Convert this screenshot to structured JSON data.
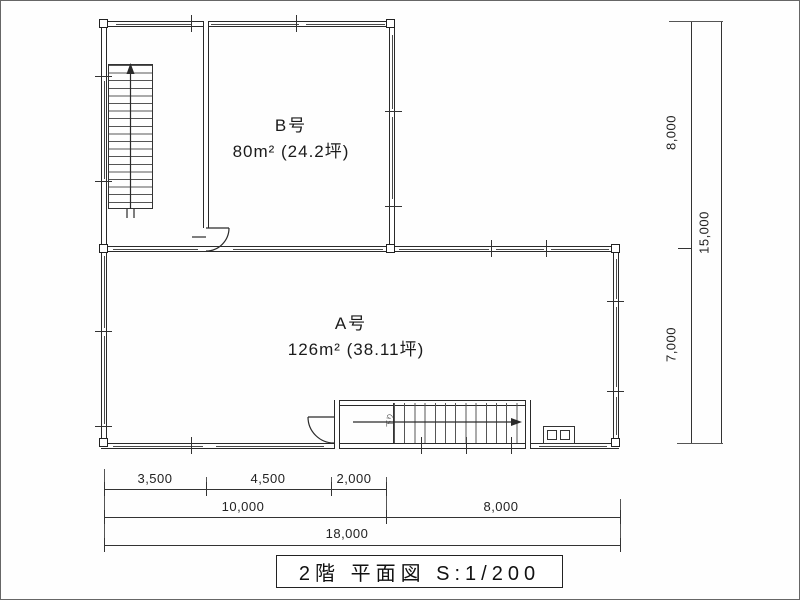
{
  "drawing": {
    "type": "architectural floor plan",
    "floor_title": "2階 平面図 S:1/200"
  },
  "rooms": {
    "b": {
      "name": "B号",
      "area": "80m² (24.2坪)"
    },
    "a": {
      "name": "A号",
      "area": "126m² (38.11坪)"
    }
  },
  "stairs": {
    "upper_left": "straight stair with up-direction arrow",
    "lower_right_label": "下り"
  },
  "dimensions": {
    "right": {
      "upper": "8,000",
      "lower": "7,000",
      "total": "15,000"
    },
    "bottom": {
      "row1": [
        "3,500",
        "4,500",
        "2,000"
      ],
      "row2": [
        "10,000",
        "8,000"
      ],
      "total": "18,000"
    }
  },
  "colors": {
    "line": "#2a2a2a",
    "background": "#fefefe"
  }
}
